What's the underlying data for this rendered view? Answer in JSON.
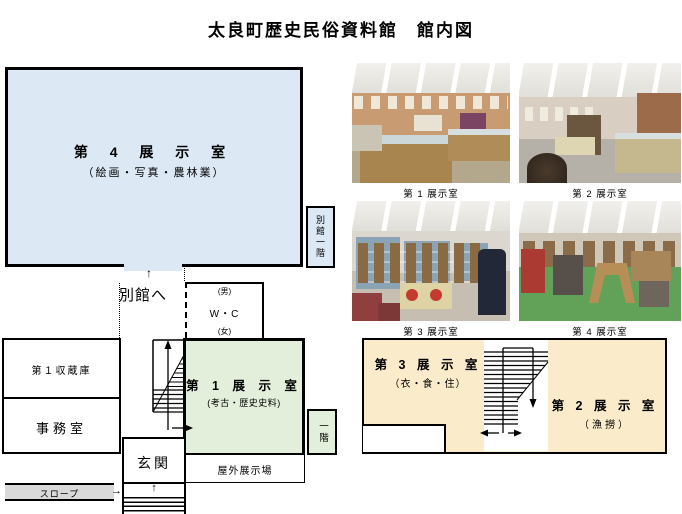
{
  "title": "太良町歴史民俗資料館　館内図",
  "colors": {
    "exhibit_room4_blue": "#dce9f5",
    "exhibit_room1_green": "#e3efda",
    "second_floor_cream": "#faecca",
    "slope_gray": "#d9d9d9"
  },
  "floor1": {
    "room4_name": "第 4 展 示 室",
    "room4_subtitle": "（絵画・写真・農林業）",
    "annex_first_floor": "別館一階",
    "to_annex": "別館へ",
    "wc_male": "(男)",
    "wc_label": "W・C",
    "wc_female": "(女)",
    "storage1": "第１収蔵庫",
    "office": "事務室",
    "slope": "スロープ",
    "entrance": "玄関",
    "room1_name": "第 1 展 示 室",
    "room1_subtitle": "(考古・歴史史料)",
    "outdoor": "屋外展示場",
    "first_floor": "一階"
  },
  "floor2": {
    "room3_name": "第 3 展 示 室",
    "room3_subtitle": "（衣・食・住）",
    "room2_name": "第 2 展 示 室",
    "room2_subtitle": "（漁撈）"
  },
  "photos": [
    {
      "caption": "第 1 展示室"
    },
    {
      "caption": "第 2 展示室"
    },
    {
      "caption": "第 3 展示室"
    },
    {
      "caption": "第 4 展示室"
    }
  ],
  "icons": {
    "up_arrow": "↑",
    "right_arrow": "→"
  }
}
